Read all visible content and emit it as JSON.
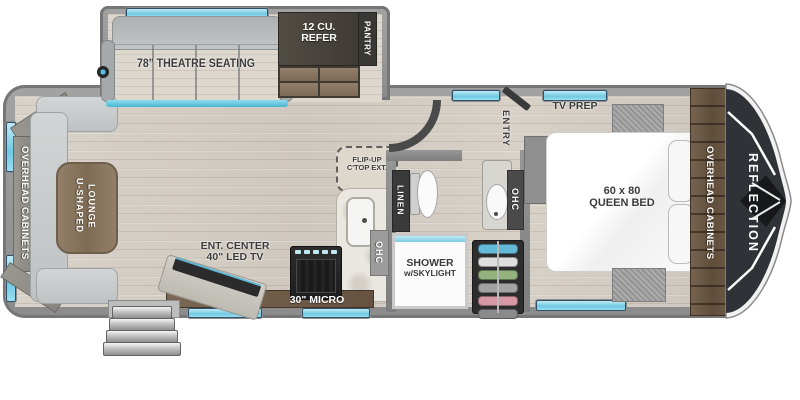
{
  "floorplan": {
    "brand": "REFLECTION",
    "labels": {
      "theatre_seating": "78\" THEATRE SEATING",
      "refer_line1": "12 CU.",
      "refer_line2": "REFER",
      "pantry": "PANTRY",
      "overhead_cabinets_left": "OVERHEAD CABINETS",
      "overhead_cabinets_right": "OVERHEAD CABINETS",
      "u_lounge_line1": "U-SHAPED",
      "u_lounge_line2": "LOUNGE",
      "ent_center_line1": "ENT. CENTER",
      "ent_center_line2": "40\" LED TV",
      "ohc_bottom": "OHC",
      "micro": "30\" MICRO",
      "flip_up_line1": "FLIP-UP",
      "flip_up_line2": "C'TOP EXT.",
      "ohc_kitchen": "OHC",
      "linen": "LINEN",
      "shower_line1": "SHOWER",
      "shower_line2": "w/SKYLIGHT",
      "ohc_bath": "OHC",
      "entry": "ENTRY",
      "tv_prep": "TV PREP",
      "bed_line1": "60 x 80",
      "bed_line2": "QUEEN BED"
    },
    "colors": {
      "accent_window": "#6fc9e2",
      "wall_gray": "#8b8b8b",
      "floor_wood": "#d6cfc6",
      "cabinet_brown": "#6b5947",
      "front_cap_black": "#2f3236",
      "label_dark": "#3b3b3b",
      "label_white": "#ffffff"
    }
  }
}
